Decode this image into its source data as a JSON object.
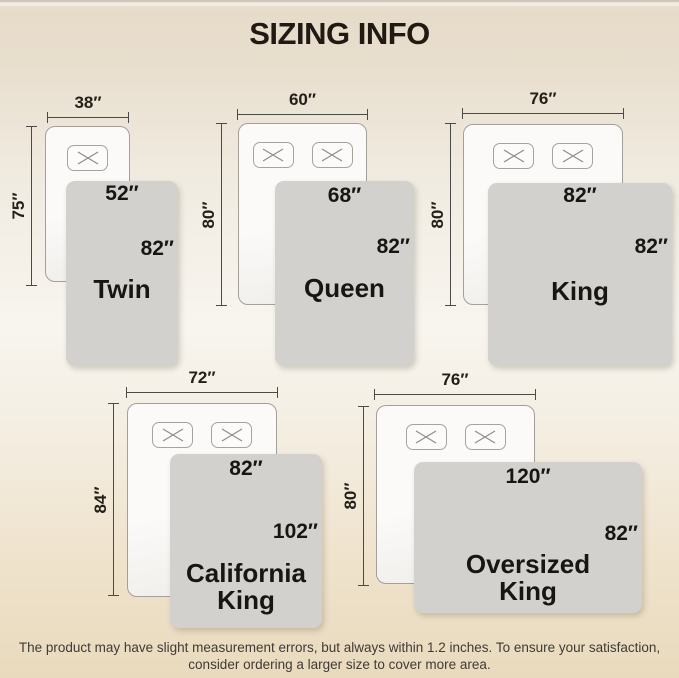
{
  "header": {
    "title": "SIZING INFO"
  },
  "sizes": [
    {
      "name": "Twin",
      "bed_width": "38″",
      "bed_length": "75″",
      "blanket_width": "52″",
      "blanket_length": "82″",
      "pillows": 1
    },
    {
      "name": "Queen",
      "bed_width": "60″",
      "bed_length": "80″",
      "blanket_width": "68″",
      "blanket_length": "82″",
      "pillows": 2
    },
    {
      "name": "King",
      "bed_width": "76″",
      "bed_length": "80″",
      "blanket_width": "82″",
      "blanket_length": "82″",
      "pillows": 2
    },
    {
      "name": "California King",
      "bed_width": "72″",
      "bed_length": "84″",
      "blanket_width": "82″",
      "blanket_length": "102″",
      "pillows": 2
    },
    {
      "name": "Oversized King",
      "bed_width": "76″",
      "bed_length": "80″",
      "blanket_width": "120″",
      "blanket_length": "82″",
      "pillows": 2
    }
  ],
  "footer": {
    "note": "The product may have slight measurement errors, but always within 1.2 inches. To ensure your satisfaction, consider ordering a larger size to cover more area."
  },
  "colors": {
    "background_top": "#e7dcca",
    "background_middle": "#f8f5ef",
    "background_bottom": "#e9dabd",
    "blanket": "#d3d1cd",
    "bed": "#fbfaf9",
    "text": "#1e1b15"
  }
}
